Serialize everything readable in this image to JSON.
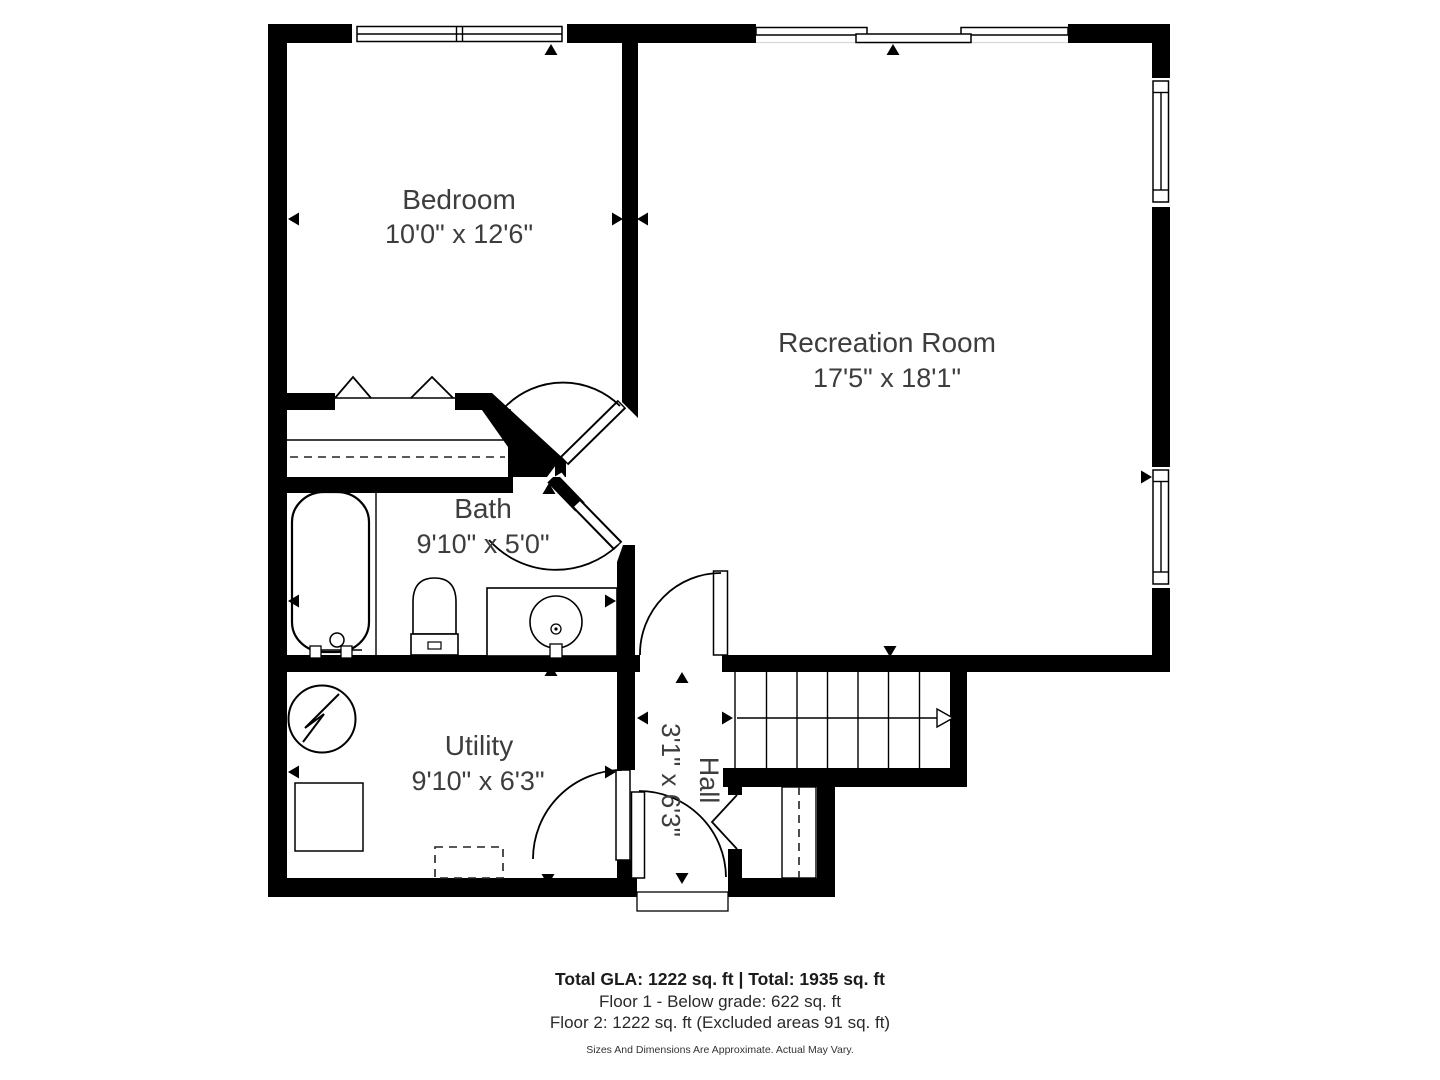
{
  "plan": {
    "rooms": {
      "bedroom": {
        "name": "Bedroom",
        "dims": "10'0\" x 12'6\""
      },
      "recreation": {
        "name": "Recreation Room",
        "dims": "17'5\" x 18'1\""
      },
      "bath": {
        "name": "Bath",
        "dims": "9'10\" x 5'0\""
      },
      "utility": {
        "name": "Utility",
        "dims": "9'10\" x 6'3\""
      },
      "hall": {
        "name": "Hall",
        "dims": "3'1\" x 6'3\""
      }
    },
    "footer": {
      "totals": "Total GLA: 1222 sq. ft | Total: 1935 sq. ft",
      "floor1": "Floor 1 - Below grade: 622 sq. ft",
      "floor2": "Floor 2: 1222 sq. ft (Excluded areas 91 sq. ft)",
      "disclaimer": "Sizes And Dimensions Are Approximate. Actual May Vary."
    },
    "colors": {
      "wall": "#000000",
      "label": "#3d3d3d",
      "footer": "#1f1f1f",
      "background": "#ffffff"
    }
  }
}
